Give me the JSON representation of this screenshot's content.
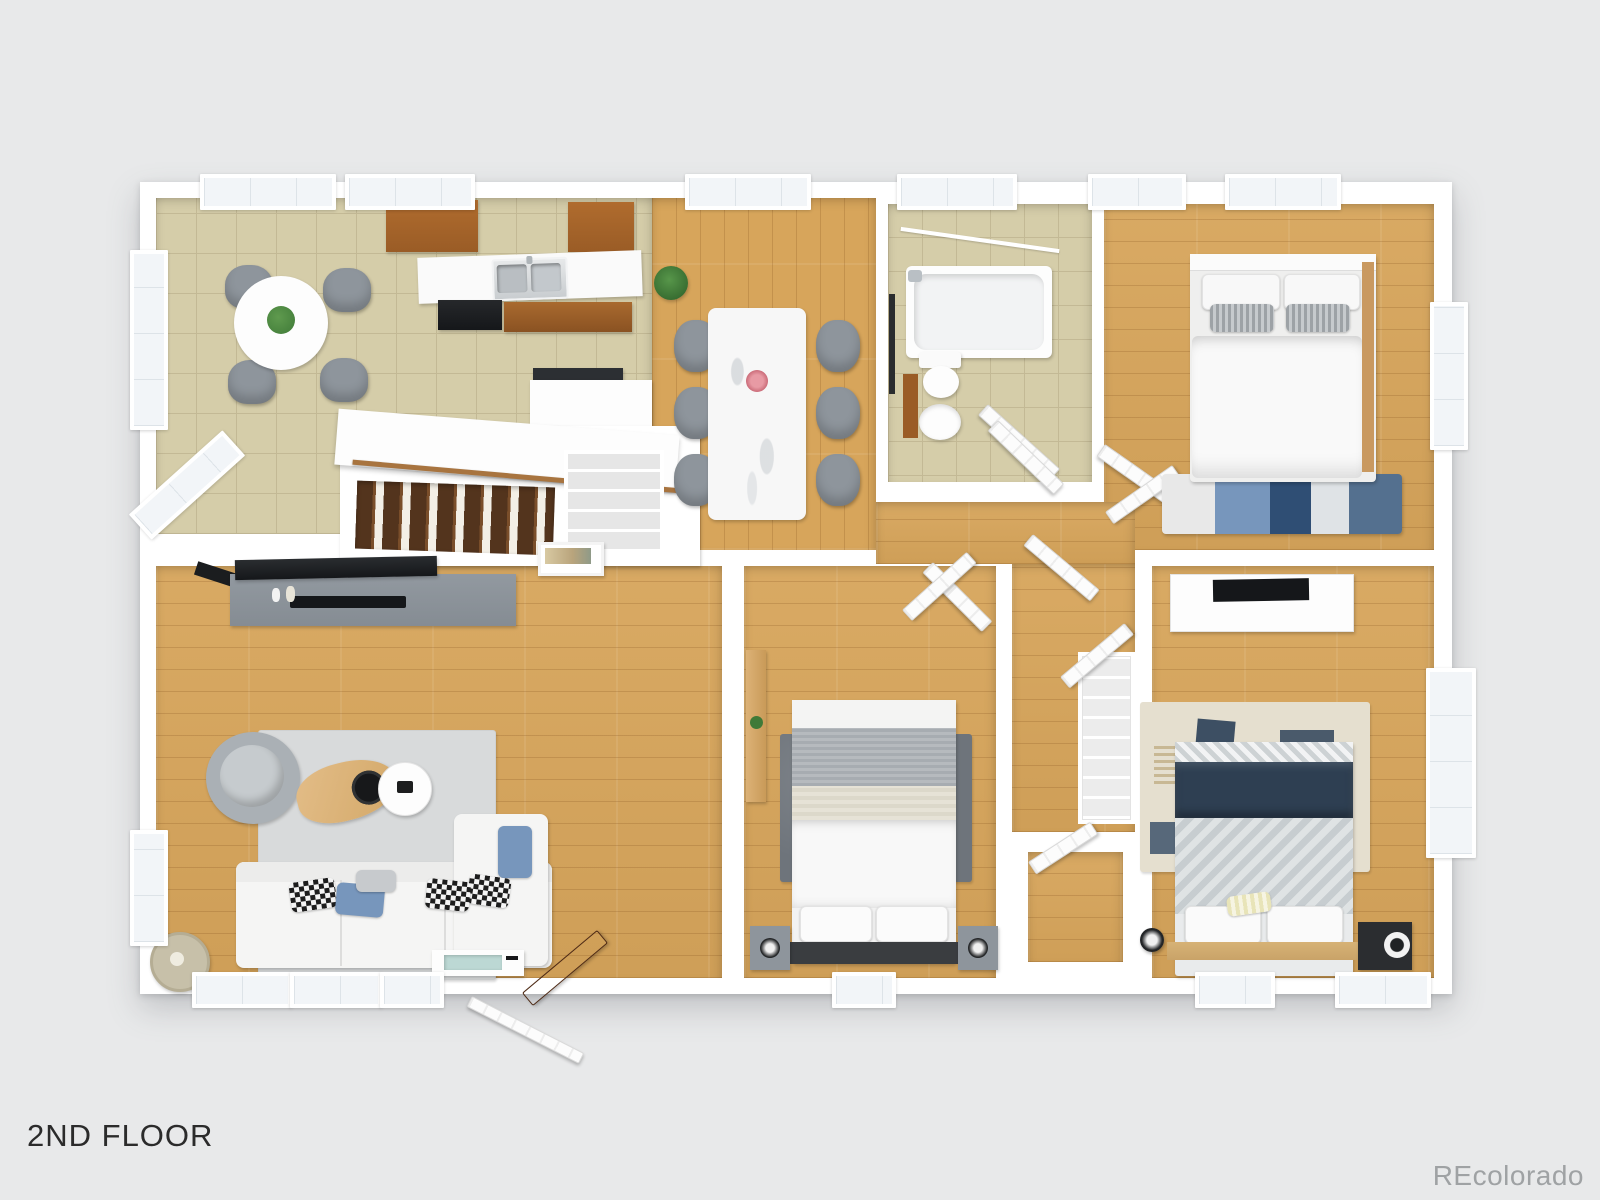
{
  "canvas": {
    "width": 1600,
    "height": 1200
  },
  "labels": {
    "floor": "2ND FLOOR",
    "watermark": "REcolorado"
  },
  "colors": {
    "page_bg": "#e8e9ea",
    "wall": "#ffffff",
    "wood_floor": "#d7a55b",
    "wood_plank_line": "rgba(125,75,25,0.22)",
    "tile_floor": "#d5cda9",
    "tile_grout": "#c3b995",
    "rug_light": "#d8dadb",
    "rug_dark": "#6e747b",
    "rug_tan": "#e5dfcf",
    "sofa_white": "#f5f5f4",
    "furniture_gray": "#8e959c",
    "console_gray": "#858c93",
    "tv_black": "#15171a",
    "cabinet_wood": "#9a5c26",
    "counter_white": "#fafafa",
    "navy": "#2e3f52",
    "herringbone_a": "#dfe3e4",
    "herringbone_b": "#c7cdd0",
    "accent_blue": "#7796bc",
    "plant_green": "#3f7a38",
    "door_wood": "#6a3a1f",
    "lamp_beige": "#c7c0a9",
    "art_yellow": "#cfc06a",
    "window_glass": "#f2f5f8",
    "steps_dark": "#53341d",
    "steps_light": "#f3efe6",
    "rail_wood": "#a8743f",
    "glass_teal": "#bcd8d4",
    "text_dark": "#2b2b2b",
    "text_watermark": "#9fa2a4"
  },
  "plan": {
    "view": "3d-top-down-floor-plan",
    "rooms": [
      {
        "name": "kitchen-breakfast-nook",
        "floor": "tile",
        "items": [
          "round-table",
          "chairs-x4",
          "potted-plant",
          "wall-art",
          "upper-cabinets",
          "sink-counter",
          "double-sink",
          "range",
          "base-cabinets",
          "peninsula-counter",
          "bay-windows"
        ]
      },
      {
        "name": "dining-area",
        "floor": "wood",
        "items": [
          "marble-dining-table",
          "chairs-x6",
          "flower-centerpiece",
          "potted-plant"
        ]
      },
      {
        "name": "bathroom",
        "floor": "tile",
        "items": [
          "bathtub",
          "shower-fixture",
          "towel-bar",
          "toilet",
          "pedestal-sink",
          "mirror",
          "door"
        ]
      },
      {
        "name": "bedroom-top-right",
        "floor": "wood",
        "items": [
          "double-bed",
          "white-pillows",
          "gray-pillows",
          "wood-headboard-rail",
          "blue-area-rug",
          "closet-double-doors",
          "windows"
        ]
      },
      {
        "name": "stairwell",
        "floor": "wood-steps",
        "items": [
          "staircase-down",
          "handrail",
          "stair-wall",
          "wire-shelf-closet",
          "small-framed-art"
        ]
      },
      {
        "name": "hallway",
        "floor": "wood",
        "items": [
          "linen-shelves",
          "open-doors-x6",
          "reach-in-closet"
        ]
      },
      {
        "name": "living-room",
        "floor": "wood",
        "items": [
          "tv",
          "tv-bracket",
          "media-console",
          "soundbar",
          "area-rug",
          "swivel-armchair",
          "wood-coffee-table",
          "black-tray",
          "white-side-table",
          "sectional-sofa-with-chaise",
          "checkered-pillows",
          "blue-pillows",
          "floor-lamp",
          "glass-top-bench",
          "front-door-open",
          "storm-door-open",
          "windows"
        ]
      },
      {
        "name": "bedroom-middle",
        "floor": "wood",
        "items": [
          "bed-gray-striped-duvet",
          "white-pillows",
          "dark-headboard",
          "nightstands-x2",
          "round-speakers",
          "wall-desk",
          "small-plant",
          "dark-gray-rug",
          "closet-door"
        ]
      },
      {
        "name": "bedroom-bottom-right",
        "floor": "wood",
        "items": [
          "dresser",
          "tv",
          "patterned-area-rug",
          "bed-navy-blanket",
          "herringbone-duvet",
          "white-pillows",
          "accent-pillow",
          "platform-base",
          "dark-nightstand",
          "round-speakers-x2",
          "closet-door",
          "windows"
        ]
      }
    ]
  }
}
